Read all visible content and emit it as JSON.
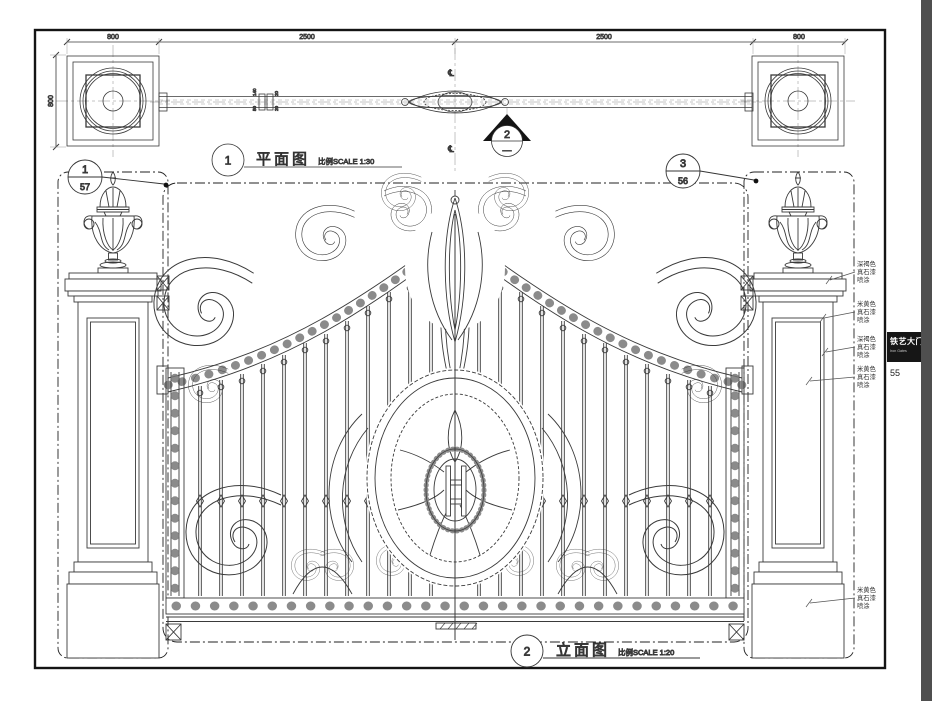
{
  "sheet": {
    "tab_title": "铁艺大门",
    "tab_subtitle": "Iron Gates",
    "page_number": "55"
  },
  "plan_view": {
    "callout_number": "1",
    "title": "平面图",
    "scale": "比例SCALE 1:30",
    "dim_top": [
      "800",
      "2500",
      "2500",
      "800"
    ],
    "dim_pillar_depth": "800",
    "dim_rail": [
      "140",
      "50",
      "20",
      "20"
    ],
    "centerline_mark": "℄",
    "section_marker": {
      "number": "2",
      "sheet": "—"
    }
  },
  "elevation_view": {
    "callout_number": "2",
    "title": "立面图",
    "scale": "比例SCALE 1:20",
    "detail_callout_left": {
      "number": "1",
      "sheet": "57"
    },
    "detail_callout_right": {
      "number": "3",
      "sheet": "56"
    },
    "finish_notes": [
      {
        "lines": [
          "深褐色",
          "真石漆",
          "喷涂"
        ]
      },
      {
        "lines": [
          "米黄色",
          "真石漆",
          "喷涂"
        ]
      },
      {
        "lines": [
          "深褐色",
          "真石漆",
          "喷涂"
        ]
      },
      {
        "lines": [
          "米黄色",
          "真石漆",
          "喷涂"
        ]
      },
      {
        "lines": [
          "米黄色",
          "真石漆",
          "喷涂"
        ]
      }
    ]
  }
}
